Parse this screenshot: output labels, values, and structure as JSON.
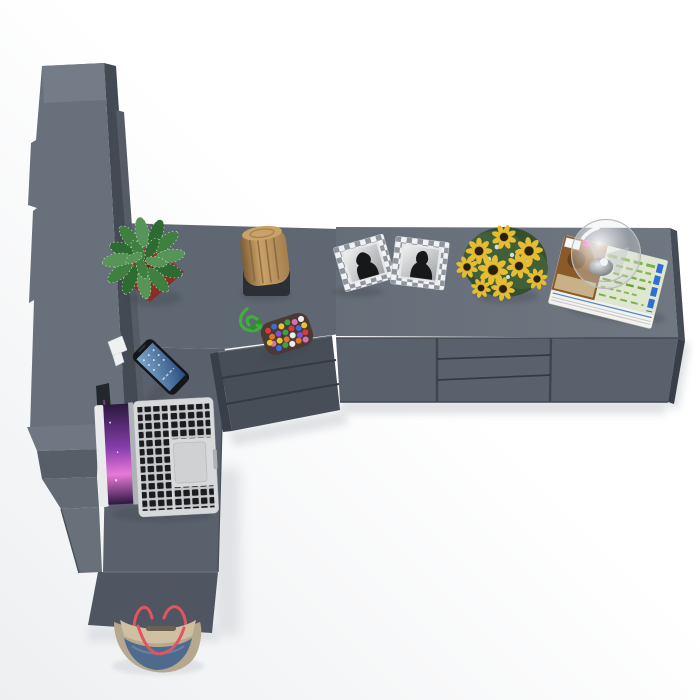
{
  "scene": {
    "title": "Top-down 3D render of a dark gray L-shaped desk with tall cabinet, drawer pedestal and sideboard, decorated with office objects",
    "floor_light": "#ffffff",
    "floor_shade": "#edeff1"
  },
  "colors": {
    "desk_top_h": "#5f6772",
    "desk_top_v": "#5a616c",
    "desk_front": "#4f5661",
    "cabinet_face": "#67707b",
    "cabinet_cap": "#747c87",
    "cabinet_side": "#434a53",
    "cabinet_side2": "#555c66",
    "step_top": "#6f7782",
    "step_front": "#575e68",
    "step_mid": "#626a74",
    "step_low": "#68707a",
    "pedestal_front": "#474e58",
    "pedestal_side": "#393f48",
    "groove": "#343a43",
    "sideboard_top_l": "#656d78",
    "sideboard_top_r": "#6f7781",
    "sideboard_front": "#59616c",
    "sideboard_side": "#454c55",
    "panel_gap": "#3f454e",
    "floor_shadow": "#dfe1e4",
    "contact_shadow": "#3c434c",
    "pot_red": "#a83a31",
    "pot_red_dark": "#7e2a22",
    "pot_rim": "#6e241f",
    "leaf_dark": "#2e6b33",
    "leaf_mid": "#3f8040",
    "leaf_light": "#569457",
    "leaf_speckle": "#cde6cc",
    "stump_light": "#c9a268",
    "stump_mid": "#a47f4e",
    "stump_dark": "#7c5c35",
    "stand_dark": "#2c3036",
    "stand_slot": "#14161a",
    "rope_green": "#3fae3c",
    "rope_green_dark": "#2f8f2e",
    "pouch_base": "#4a3a33",
    "frame_white": "#f2f2f4",
    "frame_gray": "#8f959c",
    "photo_light": "#efefef",
    "photo_mid": "#9fa2a6",
    "photo_dark": "#17181a",
    "petal_yellow": "#e5bd33",
    "flower_center": "#2a2012",
    "foliage_green": "#41603a",
    "foliage_dark": "#35502f",
    "filler_white": "#e8eaea",
    "mag_page": "#f3f2ee",
    "mag_brown": "#8a5a28",
    "mag_green_bg": "#dfe7d0",
    "mag_green": "#7ab34a",
    "mag_blue": "#2f6fd0",
    "mag_pink": "#e038a0",
    "glass_rim": "#b9bcbf",
    "glass_shade": "#9da1a5",
    "silver_dark": "#6a6e72",
    "silver_light": "#e8ebec",
    "phone_body": "#14161a",
    "phone_screen_a": "#2a4e7e",
    "phone_screen_b": "#7fa8cc",
    "laptop_silver": "#d7d9db",
    "laptop_edge": "#e8eaec",
    "hinge_gray": "#aeb1b5",
    "key_bg": "#c6c8ca",
    "key_black": "#1a1c20",
    "trackpad": "#cfd1d3",
    "screen_p1": "#2b1840",
    "screen_p2": "#8a3fae",
    "screen_p3": "#e87ad8",
    "monitor_dark": "#23262b",
    "bracket_white": "#eef0f2",
    "bag_tan": "#b5a88f",
    "bag_inner": "#cfc0a2",
    "bag_slot": "#6b6152",
    "bag_denim": "#4e6a8d",
    "bag_denim_hi": "#7a92ad",
    "bag_strap": "#e25560"
  },
  "beads": {
    "palette": [
      "#d43c3c",
      "#3d6bd0",
      "#e7c33a",
      "#3fa04b",
      "#d76fb6",
      "#ececec",
      "#e0762e",
      "#8051d4"
    ]
  },
  "inventory": {
    "furniture": [
      {
        "name": "tall-cabinet",
        "label": "Tall cabinet column"
      },
      {
        "name": "corner-desk",
        "label": "L-shaped corner desk"
      },
      {
        "name": "drawer-pedestal",
        "label": "3-drawer pedestal"
      },
      {
        "name": "sideboard",
        "label": "Sideboard with two doors and three drawers"
      }
    ],
    "decor": [
      {
        "name": "potted-plant",
        "label": "Green plant in red square pot"
      },
      {
        "name": "wood-stump",
        "label": "Wooden stump on black stand"
      },
      {
        "name": "rope-keychain",
        "label": "Green rope with beaded pouch"
      },
      {
        "name": "photo-frame",
        "label": "Two checkered photo frames"
      },
      {
        "name": "sunflower-bouquet",
        "label": "Sunflower bouquet"
      },
      {
        "name": "magazine-stack",
        "label": "Magazine stack"
      },
      {
        "name": "glass-globe-lamp",
        "label": "Glass globe lamp"
      },
      {
        "name": "smartphone",
        "label": "Smartphone"
      },
      {
        "name": "laptop",
        "label": "Open laptop"
      },
      {
        "name": "monitor-edge",
        "label": "Monitor seen edge-on"
      },
      {
        "name": "tote-bag",
        "label": "Denim tote bag on floor"
      }
    ]
  }
}
